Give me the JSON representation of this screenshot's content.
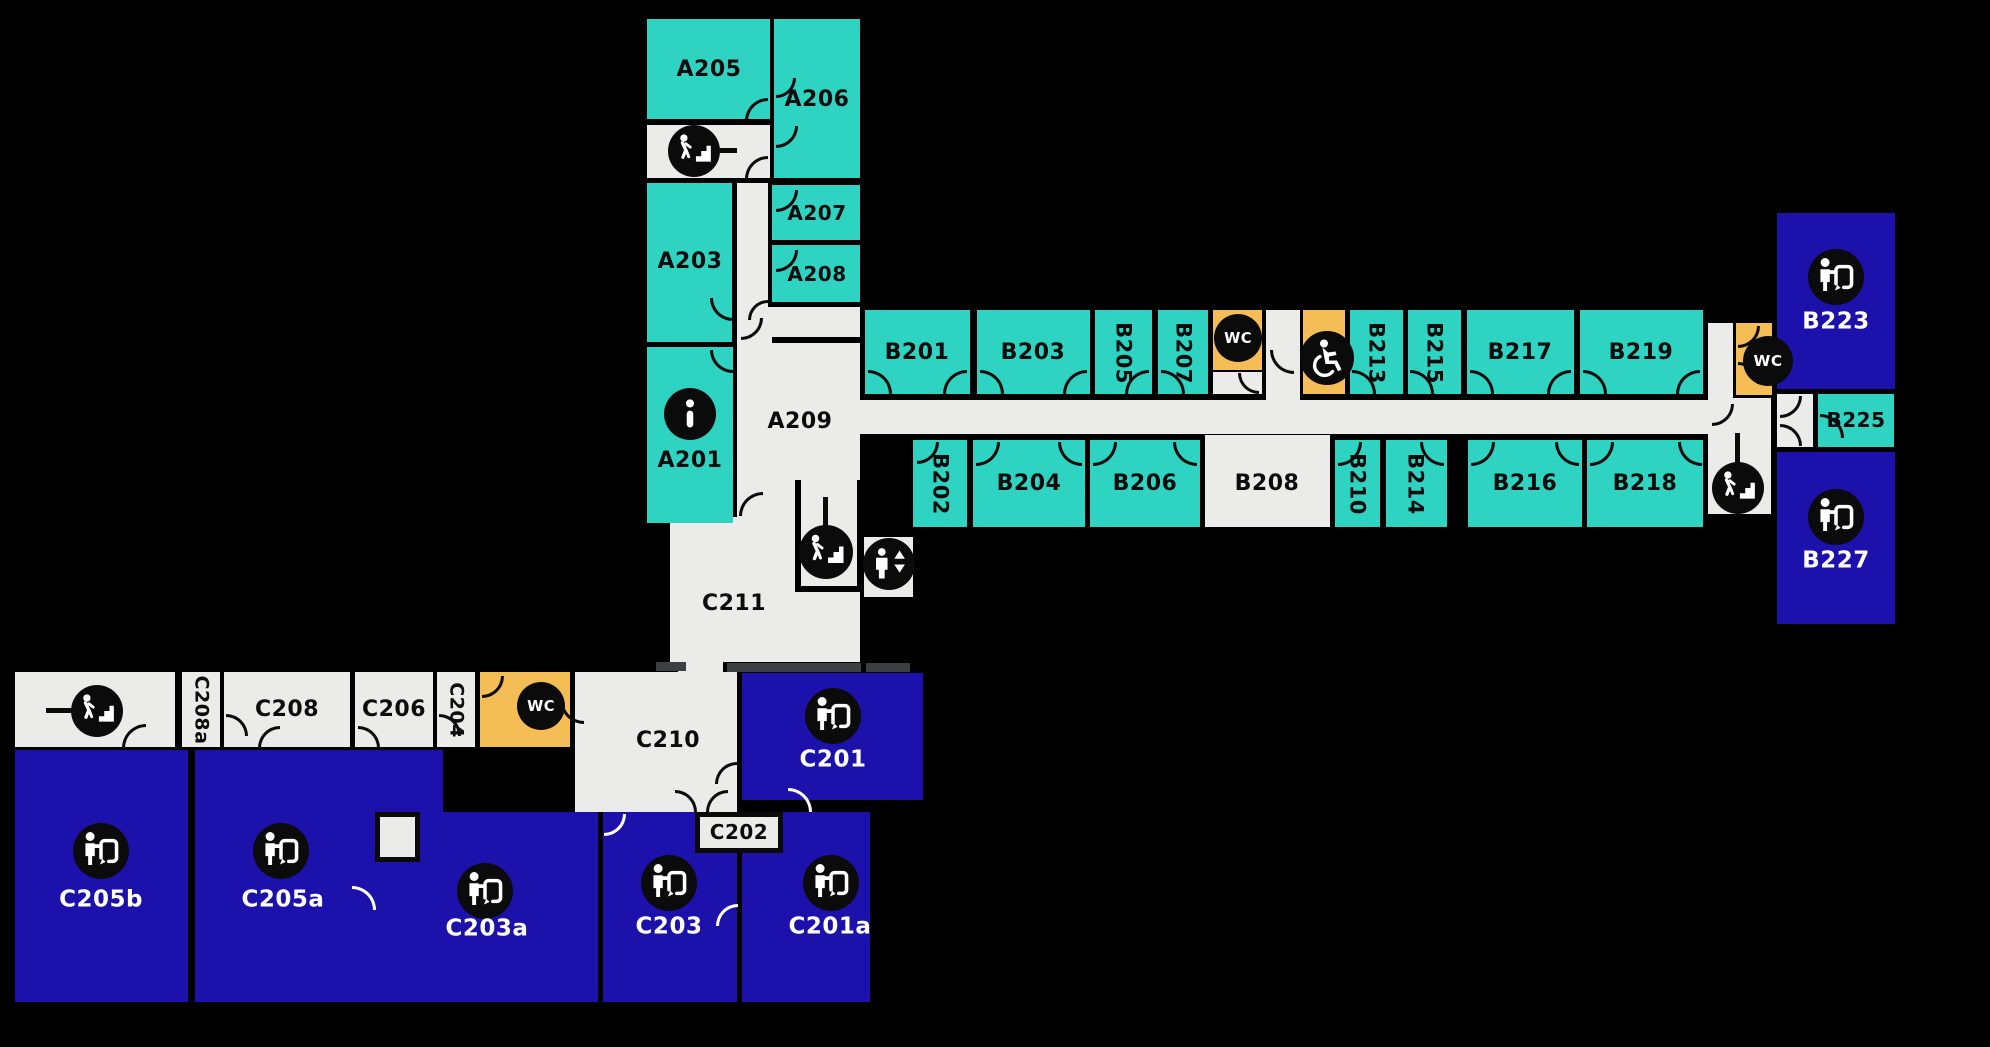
{
  "colors": {
    "room_teal": "#2ed3c1",
    "room_blue": "#1c12ab",
    "room_orange": "#f5bd55",
    "room_gray": "#ebebe9",
    "wall": "#000000",
    "threshold": "#3c4043",
    "icon_bg": "#0b0b0b",
    "label_dark": "#0c0c0c",
    "label_white": "#ffffff"
  },
  "rooms": [
    {
      "name": "a-wing-stair-landing",
      "x": 647,
      "y": 125,
      "w": 123,
      "h": 53,
      "fill": "gray"
    },
    {
      "name": "a-wing-corridor",
      "x": 737,
      "y": 183,
      "w": 31,
      "h": 130,
      "fill": "gray"
    },
    {
      "id": "A209",
      "x": 737,
      "y": 307,
      "w": 123,
      "h": 210,
      "fill": "gray"
    },
    {
      "name": "a209-c211-opening",
      "x": 779,
      "y": 509,
      "w": 78,
      "h": 14,
      "fill": "gray"
    },
    {
      "id": "C211",
      "x": 670,
      "y": 517,
      "w": 190,
      "h": 145,
      "fill": "gray"
    },
    {
      "name": "elevator-shaft",
      "x": 864,
      "y": 537,
      "w": 49,
      "h": 60,
      "fill": "gray"
    },
    {
      "name": "b-wing-corridor",
      "x": 860,
      "y": 400,
      "w": 873,
      "h": 34,
      "fill": "gray"
    },
    {
      "name": "wc-lobby-recess",
      "x": 1266,
      "y": 310,
      "w": 34,
      "h": 92,
      "fill": "gray"
    },
    {
      "name": "wc1-vestibule",
      "x": 1213,
      "y": 372,
      "w": 49,
      "h": 22,
      "fill": "gray"
    },
    {
      "id": "B208",
      "x": 1205,
      "y": 435,
      "w": 125,
      "h": 92,
      "fill": "gray"
    },
    {
      "name": "b-east-corridor",
      "x": 1708,
      "y": 323,
      "w": 25,
      "h": 79,
      "fill": "gray"
    },
    {
      "name": "b-east-stairwell",
      "x": 1708,
      "y": 398,
      "w": 63,
      "h": 116,
      "fill": "gray"
    },
    {
      "name": "b225-vestibule",
      "x": 1777,
      "y": 394,
      "w": 36,
      "h": 53,
      "fill": "gray"
    },
    {
      "name": "c-wing-stairwell",
      "x": 15,
      "y": 672,
      "w": 160,
      "h": 75,
      "fill": "gray"
    },
    {
      "id": "C208a",
      "x": 182,
      "y": 672,
      "w": 38,
      "h": 75,
      "fill": "gray"
    },
    {
      "id": "C208",
      "x": 224,
      "y": 672,
      "w": 126,
      "h": 75,
      "fill": "gray"
    },
    {
      "id": "C206",
      "x": 355,
      "y": 672,
      "w": 78,
      "h": 75,
      "fill": "gray"
    },
    {
      "id": "C204",
      "x": 437,
      "y": 672,
      "w": 38,
      "h": 75,
      "fill": "gray"
    },
    {
      "id": "C210",
      "x": 575,
      "y": 672,
      "w": 162,
      "h": 140,
      "fill": "gray"
    },
    {
      "name": "c210-c211-connector",
      "x": 678,
      "y": 630,
      "w": 45,
      "h": 45,
      "fill": "gray"
    },
    {
      "name": "wc4-vestibule",
      "x": 553,
      "y": 705,
      "w": 17,
      "h": 42,
      "fill": "gray"
    },
    {
      "id": "A205",
      "x": 647,
      "y": 19,
      "w": 123,
      "h": 100,
      "fill": "teal"
    },
    {
      "id": "A206",
      "x": 774,
      "y": 19,
      "w": 86,
      "h": 159,
      "fill": "teal"
    },
    {
      "id": "A203",
      "x": 647,
      "y": 183,
      "w": 85,
      "h": 159,
      "fill": "teal"
    },
    {
      "id": "A207",
      "x": 772,
      "y": 185,
      "w": 88,
      "h": 55,
      "fill": "teal"
    },
    {
      "id": "A208",
      "x": 772,
      "y": 245,
      "w": 88,
      "h": 57,
      "fill": "teal"
    },
    {
      "id": "A201",
      "x": 647,
      "y": 347,
      "w": 86,
      "h": 176,
      "fill": "teal"
    },
    {
      "id": "B201",
      "x": 865,
      "y": 310,
      "w": 105,
      "h": 84,
      "fill": "teal"
    },
    {
      "id": "B203",
      "x": 977,
      "y": 310,
      "w": 113,
      "h": 84,
      "fill": "teal"
    },
    {
      "id": "B205",
      "x": 1095,
      "y": 310,
      "w": 57,
      "h": 84,
      "fill": "teal"
    },
    {
      "id": "B207",
      "x": 1158,
      "y": 310,
      "w": 50,
      "h": 84,
      "fill": "teal"
    },
    {
      "id": "B213",
      "x": 1350,
      "y": 310,
      "w": 53,
      "h": 84,
      "fill": "teal"
    },
    {
      "id": "B215",
      "x": 1408,
      "y": 310,
      "w": 53,
      "h": 84,
      "fill": "teal"
    },
    {
      "id": "B217",
      "x": 1467,
      "y": 310,
      "w": 107,
      "h": 84,
      "fill": "teal"
    },
    {
      "id": "B219",
      "x": 1580,
      "y": 310,
      "w": 123,
      "h": 84,
      "fill": "teal"
    },
    {
      "id": "B202",
      "x": 913,
      "y": 440,
      "w": 54,
      "h": 87,
      "fill": "teal"
    },
    {
      "id": "B204",
      "x": 973,
      "y": 440,
      "w": 112,
      "h": 87,
      "fill": "teal"
    },
    {
      "id": "B206",
      "x": 1090,
      "y": 440,
      "w": 110,
      "h": 87,
      "fill": "teal"
    },
    {
      "id": "B210",
      "x": 1335,
      "y": 440,
      "w": 45,
      "h": 87,
      "fill": "teal"
    },
    {
      "id": "B214",
      "x": 1386,
      "y": 440,
      "w": 61,
      "h": 87,
      "fill": "teal"
    },
    {
      "id": "B216",
      "x": 1468,
      "y": 440,
      "w": 114,
      "h": 87,
      "fill": "teal"
    },
    {
      "id": "B218",
      "x": 1587,
      "y": 440,
      "w": 116,
      "h": 87,
      "fill": "teal"
    },
    {
      "id": "B225",
      "x": 1818,
      "y": 394,
      "w": 76,
      "h": 53,
      "fill": "teal"
    },
    {
      "name": "wc-b-center",
      "x": 1213,
      "y": 310,
      "w": 49,
      "h": 60,
      "fill": "orange"
    },
    {
      "name": "wc-accessible",
      "x": 1303,
      "y": 310,
      "w": 42,
      "h": 84,
      "fill": "orange"
    },
    {
      "name": "wc-b-east",
      "x": 1736,
      "y": 323,
      "w": 36,
      "h": 72,
      "fill": "orange"
    },
    {
      "name": "wc-c-wing",
      "x": 480,
      "y": 672,
      "w": 90,
      "h": 75,
      "fill": "orange"
    },
    {
      "id": "B223",
      "x": 1777,
      "y": 213,
      "w": 118,
      "h": 176,
      "fill": "blue"
    },
    {
      "id": "B227",
      "x": 1777,
      "y": 452,
      "w": 118,
      "h": 172,
      "fill": "blue"
    },
    {
      "id": "C201",
      "x": 742,
      "y": 673,
      "w": 181,
      "h": 127,
      "fill": "blue"
    },
    {
      "id": "C205b",
      "x": 15,
      "y": 750,
      "w": 173,
      "h": 252,
      "fill": "blue"
    },
    {
      "id": "C205a",
      "x": 195,
      "y": 750,
      "w": 248,
      "h": 252,
      "fill": "blue"
    },
    {
      "id": "C203a",
      "x": 377,
      "y": 812,
      "w": 221,
      "h": 190,
      "fill": "blue"
    },
    {
      "id": "C203",
      "x": 603,
      "y": 812,
      "w": 134,
      "h": 190,
      "fill": "blue"
    },
    {
      "id": "C201a",
      "x": 742,
      "y": 812,
      "w": 128,
      "h": 190,
      "fill": "blue"
    }
  ],
  "boxes": [
    {
      "name": "c203a-closet",
      "x": 375,
      "y": 812,
      "w": 45,
      "h": 50,
      "labeled": false
    },
    {
      "name": "room-C202",
      "x": 695,
      "y": 812,
      "w": 88,
      "h": 41,
      "labeled": true
    }
  ],
  "bars": [
    {
      "name": "a-stairs-tick",
      "x": 720,
      "y": 148,
      "w": 17,
      "h": 5,
      "color": "#0b0b0b"
    },
    {
      "name": "c-stairs-tick",
      "x": 46,
      "y": 708,
      "w": 26,
      "h": 5,
      "color": "#0b0b0b"
    },
    {
      "name": "center-stairs-tick",
      "x": 823,
      "y": 497,
      "w": 5,
      "h": 29,
      "color": "#0b0b0b"
    },
    {
      "name": "east-stairs-tick",
      "x": 1735,
      "y": 433,
      "w": 5,
      "h": 30,
      "color": "#0b0b0b"
    },
    {
      "name": "stairwell-wall-left",
      "x": 795,
      "y": 480,
      "w": 6,
      "h": 112,
      "color": "#000000"
    },
    {
      "name": "stairwell-wall-right",
      "x": 857,
      "y": 480,
      "w": 6,
      "h": 112,
      "color": "#000000"
    },
    {
      "name": "stairwell-wall-bottom",
      "x": 795,
      "y": 586,
      "w": 68,
      "h": 6,
      "color": "#000000"
    },
    {
      "name": "a209-wall",
      "x": 772,
      "y": 337,
      "w": 88,
      "h": 6,
      "color": "#000000"
    },
    {
      "name": "threshold-1",
      "x": 656,
      "y": 662,
      "w": 30,
      "h": 9,
      "color": "#3c4043"
    },
    {
      "name": "threshold-2",
      "x": 727,
      "y": 663,
      "w": 134,
      "h": 9,
      "color": "#3c4043"
    },
    {
      "name": "threshold-3",
      "x": 866,
      "y": 663,
      "w": 44,
      "h": 9,
      "color": "#3c4043"
    }
  ],
  "labels": [
    {
      "id": "A205",
      "text": "A205",
      "x": 709,
      "y": 70,
      "color": "dark",
      "size": 22
    },
    {
      "id": "A206",
      "text": "A206",
      "x": 817,
      "y": 100,
      "color": "dark",
      "size": 22
    },
    {
      "id": "A203",
      "text": "A203",
      "x": 690,
      "y": 262,
      "color": "dark",
      "size": 22
    },
    {
      "id": "A207",
      "text": "A207",
      "x": 817,
      "y": 213,
      "color": "dark",
      "size": 20
    },
    {
      "id": "A208",
      "text": "A208",
      "x": 817,
      "y": 274,
      "color": "dark",
      "size": 20
    },
    {
      "id": "A201",
      "text": "A201",
      "x": 690,
      "y": 461,
      "color": "dark",
      "size": 22
    },
    {
      "id": "A209",
      "text": "A209",
      "x": 800,
      "y": 422,
      "color": "dark",
      "size": 22
    },
    {
      "id": "B201",
      "text": "B201",
      "x": 917,
      "y": 353,
      "color": "dark",
      "size": 22
    },
    {
      "id": "B203",
      "text": "B203",
      "x": 1033,
      "y": 353,
      "color": "dark",
      "size": 22
    },
    {
      "id": "B205",
      "text": "B205",
      "x": 1123,
      "y": 353,
      "color": "dark",
      "size": 21,
      "vertical": true
    },
    {
      "id": "B207",
      "text": "B207",
      "x": 1183,
      "y": 353,
      "color": "dark",
      "size": 21,
      "vertical": true
    },
    {
      "id": "B213",
      "text": "B213",
      "x": 1376,
      "y": 353,
      "color": "dark",
      "size": 21,
      "vertical": true
    },
    {
      "id": "B215",
      "text": "B215",
      "x": 1434,
      "y": 353,
      "color": "dark",
      "size": 21,
      "vertical": true
    },
    {
      "id": "B217",
      "text": "B217",
      "x": 1520,
      "y": 353,
      "color": "dark",
      "size": 22
    },
    {
      "id": "B219",
      "text": "B219",
      "x": 1641,
      "y": 353,
      "color": "dark",
      "size": 22
    },
    {
      "id": "B202",
      "text": "B202",
      "x": 940,
      "y": 484,
      "color": "dark",
      "size": 21,
      "vertical": true
    },
    {
      "id": "B204",
      "text": "B204",
      "x": 1029,
      "y": 484,
      "color": "dark",
      "size": 22
    },
    {
      "id": "B206",
      "text": "B206",
      "x": 1145,
      "y": 484,
      "color": "dark",
      "size": 22
    },
    {
      "id": "B208",
      "text": "B208",
      "x": 1267,
      "y": 484,
      "color": "dark",
      "size": 22
    },
    {
      "id": "B210",
      "text": "B210",
      "x": 1357,
      "y": 484,
      "color": "dark",
      "size": 21,
      "vertical": true
    },
    {
      "id": "B214",
      "text": "B214",
      "x": 1415,
      "y": 484,
      "color": "dark",
      "size": 21,
      "vertical": true
    },
    {
      "id": "B216",
      "text": "B216",
      "x": 1525,
      "y": 484,
      "color": "dark",
      "size": 22
    },
    {
      "id": "B218",
      "text": "B218",
      "x": 1645,
      "y": 484,
      "color": "dark",
      "size": 22
    },
    {
      "id": "B223",
      "text": "B223",
      "x": 1836,
      "y": 322,
      "color": "white",
      "size": 23
    },
    {
      "id": "B225",
      "text": "B225",
      "x": 1856,
      "y": 420,
      "color": "dark",
      "size": 20
    },
    {
      "id": "B227",
      "text": "B227",
      "x": 1836,
      "y": 561,
      "color": "white",
      "size": 23
    },
    {
      "id": "C211",
      "text": "C211",
      "x": 734,
      "y": 604,
      "color": "dark",
      "size": 22
    },
    {
      "id": "C210",
      "text": "C210",
      "x": 668,
      "y": 741,
      "color": "dark",
      "size": 22
    },
    {
      "id": "C208a",
      "text": "C208a",
      "x": 201,
      "y": 710,
      "color": "dark",
      "size": 19,
      "vertical": true
    },
    {
      "id": "C208",
      "text": "C208",
      "x": 287,
      "y": 710,
      "color": "dark",
      "size": 22
    },
    {
      "id": "C206",
      "text": "C206",
      "x": 394,
      "y": 710,
      "color": "dark",
      "size": 22
    },
    {
      "id": "C204",
      "text": "C204",
      "x": 456,
      "y": 710,
      "color": "dark",
      "size": 19,
      "vertical": true
    },
    {
      "id": "C202",
      "text": "C202",
      "x": 739,
      "y": 832,
      "color": "dark",
      "size": 20
    },
    {
      "id": "C201",
      "text": "C201",
      "x": 833,
      "y": 760,
      "color": "white",
      "size": 23
    },
    {
      "id": "C205b",
      "text": "C205b",
      "x": 101,
      "y": 900,
      "color": "white",
      "size": 23
    },
    {
      "id": "C205a",
      "text": "C205a",
      "x": 283,
      "y": 900,
      "color": "white",
      "size": 23
    },
    {
      "id": "C203a",
      "text": "C203a",
      "x": 487,
      "y": 929,
      "color": "white",
      "size": 23
    },
    {
      "id": "C203",
      "text": "C203",
      "x": 669,
      "y": 927,
      "color": "white",
      "size": 23
    },
    {
      "id": "C201a",
      "text": "C201a",
      "x": 830,
      "y": 927,
      "color": "white",
      "size": 23
    }
  ],
  "icons": [
    {
      "type": "stairs",
      "cx": 694,
      "cy": 151,
      "r": 26
    },
    {
      "type": "stairs",
      "cx": 826,
      "cy": 552,
      "r": 27
    },
    {
      "type": "stairs",
      "cx": 1738,
      "cy": 488,
      "r": 26
    },
    {
      "type": "stairs",
      "cx": 97,
      "cy": 711,
      "r": 26
    },
    {
      "type": "info",
      "cx": 690,
      "cy": 414,
      "r": 26
    },
    {
      "type": "wc",
      "cx": 1238,
      "cy": 338,
      "r": 24
    },
    {
      "type": "accessible",
      "cx": 1327,
      "cy": 358,
      "r": 27
    },
    {
      "type": "wc",
      "cx": 1768,
      "cy": 361,
      "r": 25
    },
    {
      "type": "wc",
      "cx": 541,
      "cy": 706,
      "r": 24
    },
    {
      "type": "elevator",
      "cx": 889,
      "cy": 564,
      "r": 26
    },
    {
      "type": "presenter",
      "cx": 1836,
      "cy": 277,
      "r": 28
    },
    {
      "type": "presenter",
      "cx": 1836,
      "cy": 517,
      "r": 28
    },
    {
      "type": "presenter",
      "cx": 833,
      "cy": 716,
      "r": 28
    },
    {
      "type": "presenter",
      "cx": 101,
      "cy": 851,
      "r": 28
    },
    {
      "type": "presenter",
      "cx": 281,
      "cy": 851,
      "r": 28
    },
    {
      "type": "presenter",
      "cx": 485,
      "cy": 891,
      "r": 28
    },
    {
      "type": "presenter",
      "cx": 669,
      "cy": 883,
      "r": 28
    },
    {
      "type": "presenter",
      "cx": 831,
      "cy": 883,
      "r": 28
    }
  ],
  "arcs": [
    {
      "x": 745,
      "y": 98,
      "s": 23,
      "c": "tl"
    },
    {
      "x": 745,
      "y": 156,
      "s": 23,
      "c": "tl"
    },
    {
      "x": 776,
      "y": 78,
      "s": 20,
      "c": "br"
    },
    {
      "x": 776,
      "y": 126,
      "s": 22,
      "c": "br"
    },
    {
      "x": 776,
      "y": 190,
      "s": 22,
      "c": "br"
    },
    {
      "x": 776,
      "y": 250,
      "s": 22,
      "c": "br"
    },
    {
      "x": 710,
      "y": 298,
      "s": 23,
      "c": "bl"
    },
    {
      "x": 741,
      "y": 318,
      "s": 22,
      "c": "br"
    },
    {
      "x": 748,
      "y": 300,
      "s": 20,
      "c": "tl"
    },
    {
      "x": 710,
      "y": 350,
      "s": 23,
      "c": "bl"
    },
    {
      "x": 739,
      "y": 492,
      "s": 24,
      "c": "tl"
    },
    {
      "x": 868,
      "y": 370,
      "s": 24,
      "c": "tr"
    },
    {
      "x": 943,
      "y": 370,
      "s": 24,
      "c": "tl"
    },
    {
      "x": 980,
      "y": 370,
      "s": 24,
      "c": "tr"
    },
    {
      "x": 1063,
      "y": 370,
      "s": 24,
      "c": "tl"
    },
    {
      "x": 1125,
      "y": 370,
      "s": 24,
      "c": "tl"
    },
    {
      "x": 1161,
      "y": 370,
      "s": 24,
      "c": "tr"
    },
    {
      "x": 1352,
      "y": 370,
      "s": 24,
      "c": "tr"
    },
    {
      "x": 1410,
      "y": 370,
      "s": 24,
      "c": "tr"
    },
    {
      "x": 1470,
      "y": 370,
      "s": 24,
      "c": "tr"
    },
    {
      "x": 1547,
      "y": 370,
      "s": 24,
      "c": "tl"
    },
    {
      "x": 1583,
      "y": 370,
      "s": 24,
      "c": "tr"
    },
    {
      "x": 1676,
      "y": 370,
      "s": 24,
      "c": "tl"
    },
    {
      "x": 917,
      "y": 442,
      "s": 22,
      "c": "br"
    },
    {
      "x": 976,
      "y": 442,
      "s": 24,
      "c": "br"
    },
    {
      "x": 1058,
      "y": 442,
      "s": 24,
      "c": "bl"
    },
    {
      "x": 1093,
      "y": 442,
      "s": 24,
      "c": "br"
    },
    {
      "x": 1173,
      "y": 442,
      "s": 24,
      "c": "bl"
    },
    {
      "x": 1338,
      "y": 442,
      "s": 24,
      "c": "br"
    },
    {
      "x": 1420,
      "y": 442,
      "s": 24,
      "c": "bl"
    },
    {
      "x": 1471,
      "y": 442,
      "s": 24,
      "c": "br"
    },
    {
      "x": 1555,
      "y": 442,
      "s": 24,
      "c": "bl"
    },
    {
      "x": 1590,
      "y": 442,
      "s": 24,
      "c": "br"
    },
    {
      "x": 1678,
      "y": 442,
      "s": 24,
      "c": "bl"
    },
    {
      "x": 1238,
      "y": 373,
      "s": 21,
      "c": "bl"
    },
    {
      "x": 1270,
      "y": 350,
      "s": 24,
      "c": "bl"
    },
    {
      "x": 1712,
      "y": 404,
      "s": 22,
      "c": "br"
    },
    {
      "x": 1738,
      "y": 326,
      "s": 22,
      "c": "br"
    },
    {
      "x": 1738,
      "y": 362,
      "s": 22,
      "c": "tr"
    },
    {
      "x": 1780,
      "y": 396,
      "s": 22,
      "c": "br"
    },
    {
      "x": 1780,
      "y": 424,
      "s": 22,
      "c": "tr"
    },
    {
      "x": 1820,
      "y": 414,
      "s": 24,
      "c": "tr"
    },
    {
      "x": 122,
      "y": 724,
      "s": 24,
      "c": "tl"
    },
    {
      "x": 226,
      "y": 714,
      "s": 22,
      "c": "tr"
    },
    {
      "x": 258,
      "y": 726,
      "s": 22,
      "c": "tl"
    },
    {
      "x": 358,
      "y": 726,
      "s": 22,
      "c": "tr"
    },
    {
      "x": 439,
      "y": 714,
      "s": 22,
      "c": "tr"
    },
    {
      "x": 482,
      "y": 676,
      "s": 22,
      "c": "br"
    },
    {
      "x": 560,
      "y": 700,
      "s": 24,
      "c": "bl"
    },
    {
      "x": 675,
      "y": 790,
      "s": 22,
      "c": "tr"
    },
    {
      "x": 706,
      "y": 790,
      "s": 22,
      "c": "tl"
    },
    {
      "x": 715,
      "y": 762,
      "s": 22,
      "c": "tl"
    },
    {
      "x": 788,
      "y": 788,
      "s": 24,
      "c": "tr",
      "white": true
    },
    {
      "x": 352,
      "y": 886,
      "s": 24,
      "c": "tr",
      "white": true
    },
    {
      "x": 604,
      "y": 814,
      "s": 22,
      "c": "br",
      "white": true
    },
    {
      "x": 716,
      "y": 904,
      "s": 22,
      "c": "tl",
      "white": true
    }
  ]
}
